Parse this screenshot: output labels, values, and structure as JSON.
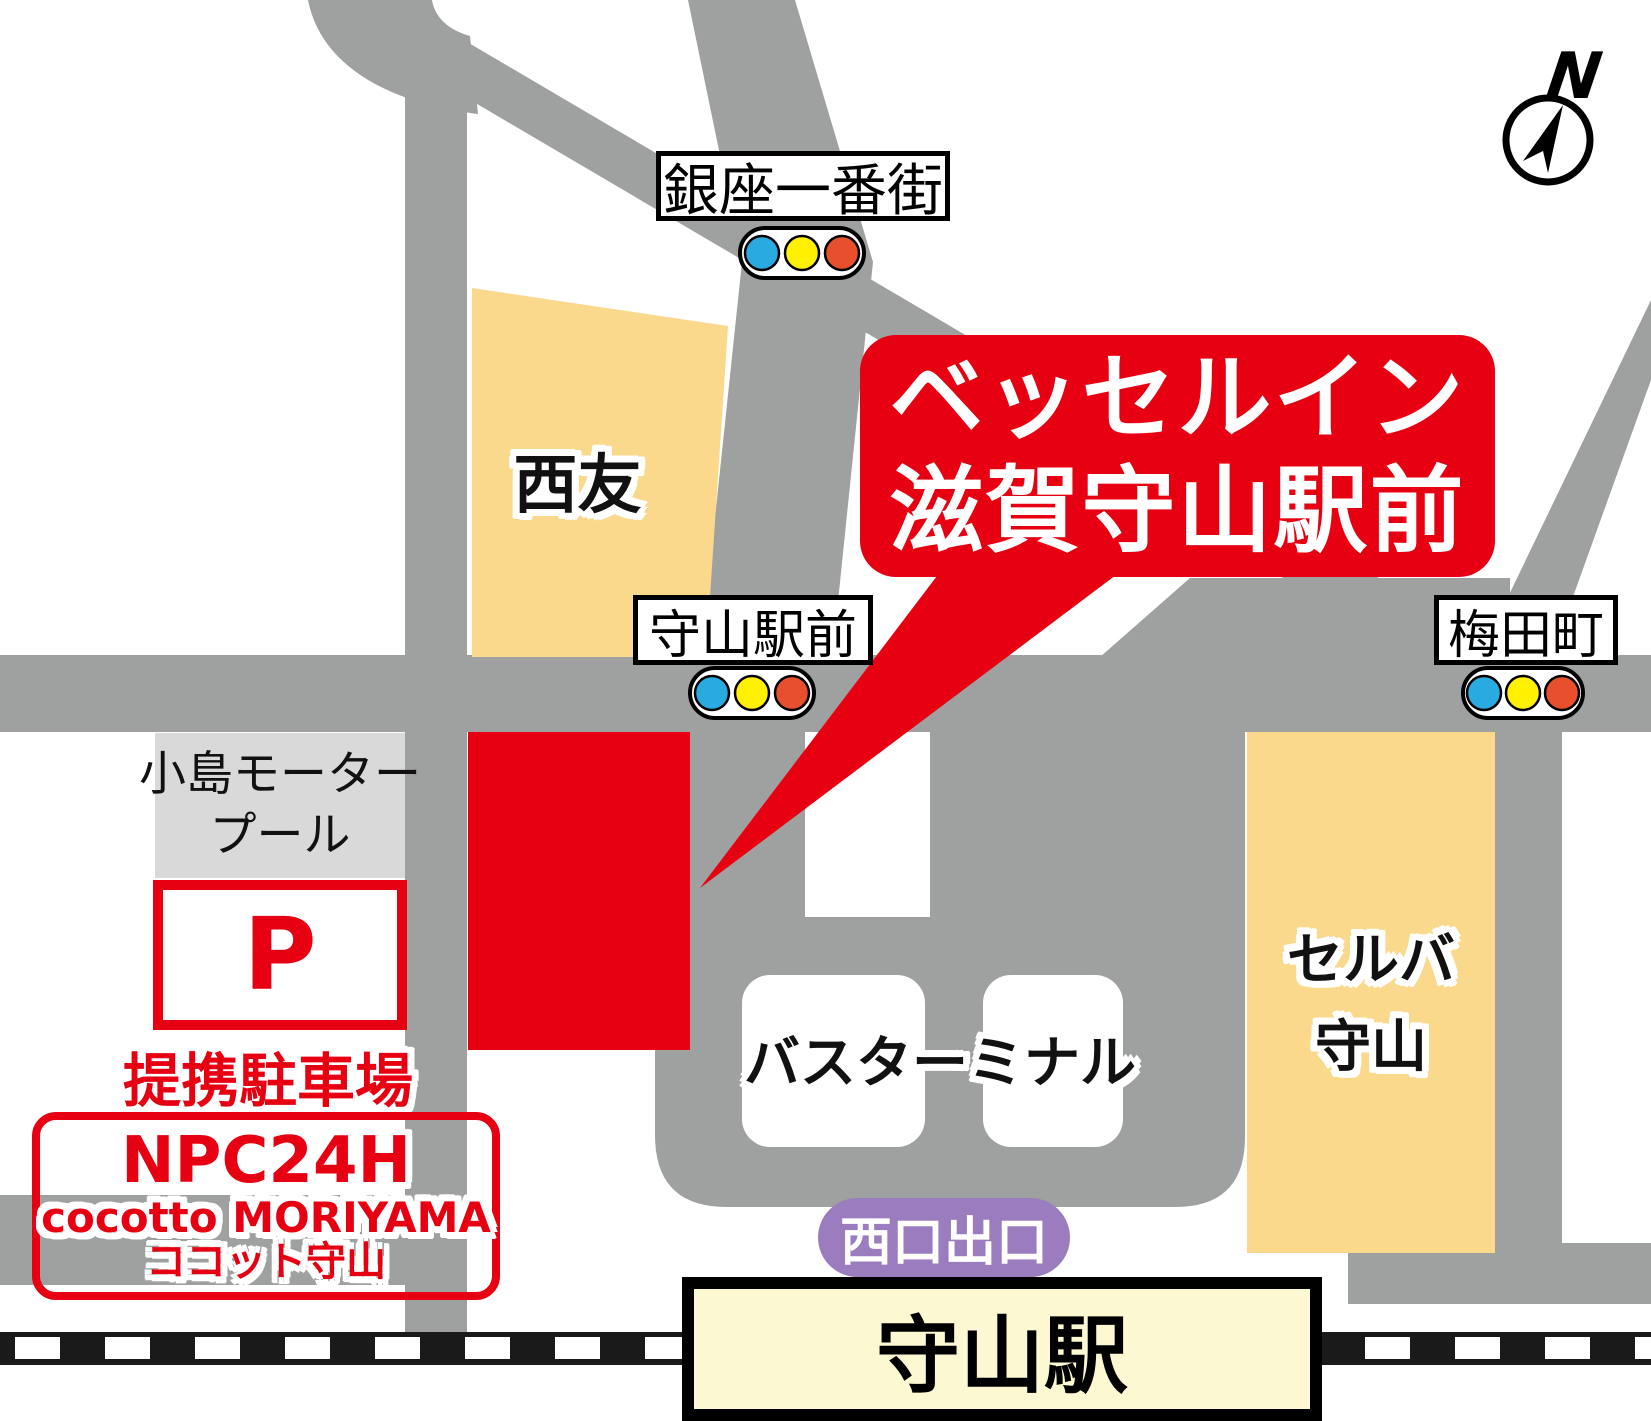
{
  "map_title": "access-map",
  "compass": {
    "label": "N"
  },
  "callout": {
    "line1": "ベッセルイン",
    "line2": "滋賀守山駅前"
  },
  "intersections": {
    "ginza": {
      "label": "銀座一番街"
    },
    "ekimae": {
      "label": "守山駅前"
    },
    "umedacho": {
      "label": "梅田町"
    }
  },
  "buildings": {
    "seiyu": {
      "label": "西友"
    },
    "selva": {
      "line1": "セルバ",
      "line2": "守山"
    },
    "kojima": {
      "line1": "小島モーター",
      "line2": "プール"
    },
    "bus_terminal": {
      "label": "バスターミナル"
    }
  },
  "parking": {
    "p_mark": "P",
    "caption": "提携駐車場",
    "name_line1": "NPC24H",
    "name_line2": "cocotto MORIYAMA",
    "name_line3": "ココット守山"
  },
  "station": {
    "name": "守山駅",
    "exit_label": "西口出口"
  },
  "colors": {
    "road": "#9FA0A0",
    "building_tan": "#FAD88C",
    "building_gray": "#D9D9DA",
    "brand_red": "#E60012",
    "station_fill": "#FCF8D2",
    "exit_purple": "#9B7CBE",
    "signal_blue": "#29ABE2",
    "signal_yellow": "#FFF100",
    "signal_red": "#E8502D",
    "rail_black": "#1A1A1A"
  }
}
